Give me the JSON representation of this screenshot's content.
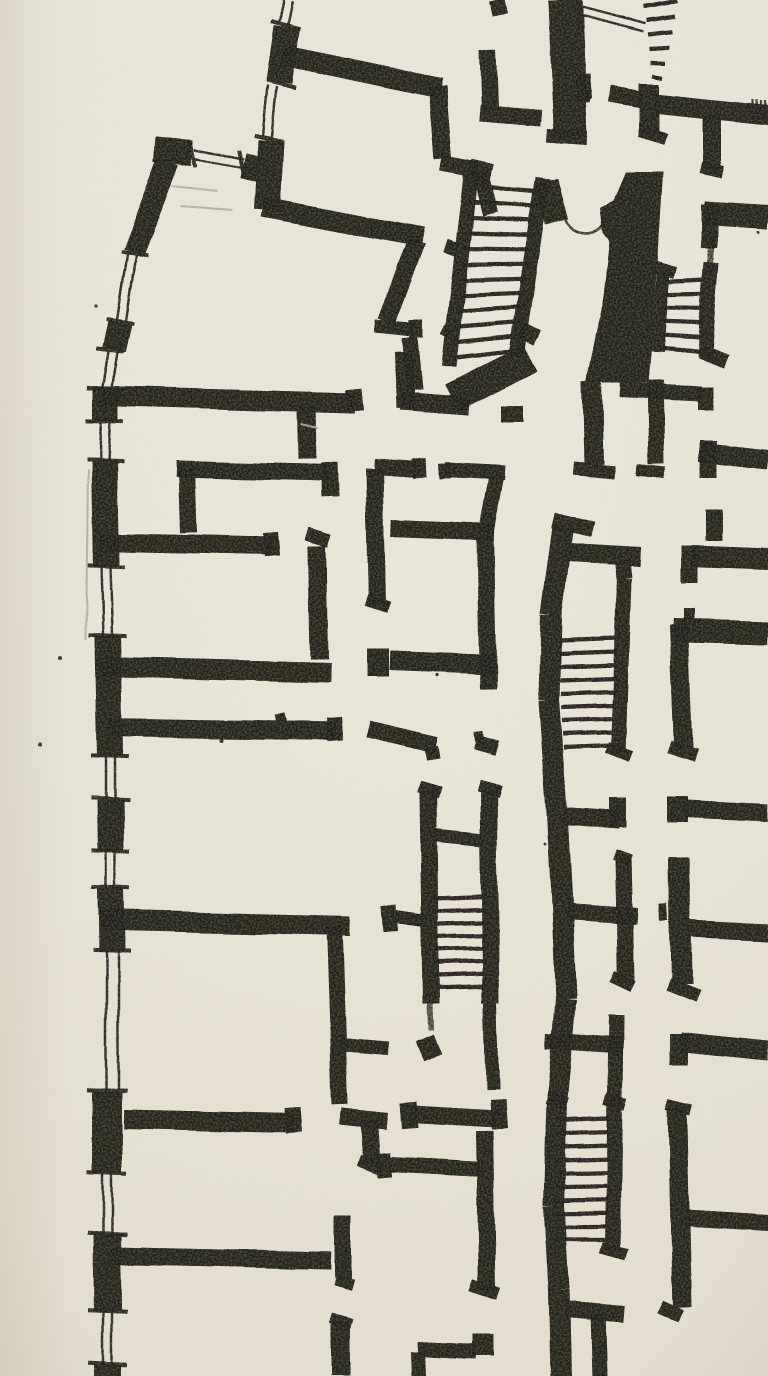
{
  "meta": {
    "title": "Hand-drawn architectural floor plan sketch (pencil on paper)",
    "canvas": {
      "width": 768,
      "height": 1376
    }
  },
  "palette": {
    "paper": "#ebe7da",
    "paper_low": "#e6e1d2",
    "ink": "#1c1b15",
    "pencil": "#b4ad9c",
    "edge_shadow": "#8a8066"
  },
  "plan": {
    "walls": [
      [
        106,
        386,
        106,
        421,
        26
      ],
      [
        104,
        461,
        106,
        566,
        26
      ],
      [
        108,
        636,
        110,
        756,
        26
      ],
      [
        110,
        799,
        111,
        851,
        26
      ],
      [
        111,
        888,
        112,
        951,
        26
      ],
      [
        107,
        1091,
        107,
        1173,
        30
      ],
      [
        107,
        1234,
        108,
        1311,
        28
      ],
      [
        108,
        1365,
        108,
        1376,
        28
      ],
      [
        287,
        27,
        279,
        82,
        26
      ],
      [
        271,
        140,
        267,
        210,
        26
      ],
      [
        155,
        150,
        192,
        153,
        26
      ],
      [
        243,
        165,
        259,
        169,
        26
      ],
      [
        168,
        162,
        133,
        253,
        22
      ],
      [
        120,
        322,
        114,
        350,
        24
      ],
      [
        283,
        55,
        440,
        88,
        21
      ],
      [
        437,
        86,
        443,
        160,
        18
      ],
      [
        441,
        164,
        478,
        171,
        16
      ],
      [
        481,
        173,
        491,
        214,
        16
      ],
      [
        263,
        207,
        422,
        237,
        20
      ],
      [
        416,
        241,
        386,
        321,
        18
      ],
      [
        374,
        326,
        414,
        330,
        14
      ],
      [
        416,
        320,
        416,
        338,
        14
      ],
      [
        409,
        338,
        414,
        390,
        16
      ],
      [
        400,
        401,
        470,
        406,
        18
      ],
      [
        403,
        352,
        405,
        408,
        18
      ],
      [
        487,
        50,
        489,
        109,
        17
      ],
      [
        479,
        113,
        541,
        118,
        17
      ],
      [
        565,
        0,
        571,
        137,
        34
      ],
      [
        547,
        136,
        588,
        139,
        14
      ],
      [
        577,
        95,
        591,
        97,
        12
      ],
      [
        497,
        0,
        500,
        14,
        15
      ],
      [
        471,
        176,
        449,
        366,
        15
      ],
      [
        543,
        178,
        516,
        356,
        15
      ],
      [
        546,
        181,
        557,
        222,
        24
      ],
      [
        470,
        170,
        492,
        175,
        20
      ],
      [
        452,
        398,
        530,
        358,
        30
      ],
      [
        513,
        406,
        513,
        422,
        22
      ],
      [
        445,
        246,
        457,
        250,
        14
      ],
      [
        443,
        330,
        451,
        334,
        10
      ],
      [
        521,
        330,
        537,
        338,
        16
      ],
      [
        649,
        84,
        649,
        134,
        20
      ],
      [
        640,
        132,
        666,
        140,
        12
      ],
      [
        654,
        103,
        768,
        115,
        20
      ],
      [
        610,
        94,
        643,
        100,
        16
      ],
      [
        583,
        75,
        585,
        100,
        14
      ],
      [
        712,
        114,
        712,
        170,
        18
      ],
      [
        701,
        168,
        723,
        173,
        12
      ],
      [
        704,
        213,
        768,
        217,
        24
      ],
      [
        709,
        204,
        709,
        248,
        16
      ],
      [
        711,
        230,
        711,
        272,
        6,
        0.65
      ],
      [
        664,
        273,
        657,
        352,
        13
      ],
      [
        712,
        262,
        704,
        358,
        15
      ],
      [
        655,
        267,
        676,
        273,
        12
      ],
      [
        700,
        352,
        726,
        362,
        14
      ],
      [
        592,
        382,
        594,
        464,
        20
      ],
      [
        573,
        468,
        615,
        472,
        13
      ],
      [
        655,
        380,
        657,
        464,
        16
      ],
      [
        637,
        470,
        666,
        473,
        12
      ],
      [
        620,
        390,
        701,
        394,
        16
      ],
      [
        705,
        387,
        705,
        411,
        16
      ],
      [
        700,
        452,
        768,
        460,
        20
      ],
      [
        709,
        441,
        709,
        478,
        17
      ],
      [
        713,
        509,
        713,
        541,
        17
      ],
      [
        691,
        556,
        768,
        559,
        21
      ],
      [
        690,
        546,
        690,
        583,
        17
      ],
      [
        673,
        630,
        768,
        633,
        24
      ],
      [
        679,
        624,
        684,
        748,
        19
      ],
      [
        670,
        746,
        697,
        755,
        13
      ],
      [
        689,
        608,
        689,
        622,
        11
      ],
      [
        678,
        797,
        678,
        822,
        20
      ],
      [
        686,
        809,
        768,
        813,
        17
      ],
      [
        680,
        858,
        682,
        984,
        21
      ],
      [
        668,
        984,
        698,
        996,
        13
      ],
      [
        690,
        929,
        768,
        933,
        17
      ],
      [
        664,
        903,
        665,
        921,
        8
      ],
      [
        679,
        1034,
        679,
        1064,
        19
      ],
      [
        681,
        1042,
        768,
        1051,
        19
      ],
      [
        677,
        1107,
        682,
        1307,
        19
      ],
      [
        667,
        1104,
        691,
        1110,
        11
      ],
      [
        684,
        1218,
        768,
        1223,
        17
      ],
      [
        660,
        1306,
        680,
        1316,
        14
      ],
      [
        563,
        527,
        551,
        615,
        21
      ],
      [
        551,
        615,
        549,
        700,
        21
      ],
      [
        549,
        700,
        557,
        812,
        21
      ],
      [
        557,
        812,
        562,
        905,
        21
      ],
      [
        562,
        905,
        566,
        1000,
        21
      ],
      [
        566,
        1000,
        557,
        1100,
        21
      ],
      [
        557,
        1100,
        554,
        1205,
        21
      ],
      [
        554,
        1205,
        559,
        1290,
        21
      ],
      [
        559,
        1290,
        561,
        1376,
        21
      ],
      [
        553,
        520,
        592,
        529,
        16
      ],
      [
        568,
        553,
        641,
        557,
        19
      ],
      [
        622,
        561,
        624,
        578,
        16
      ],
      [
        624,
        578,
        618,
        753,
        15
      ],
      [
        607,
        748,
        631,
        757,
        12
      ],
      [
        563,
        816,
        619,
        820,
        17
      ],
      [
        617,
        799,
        617,
        827,
        17
      ],
      [
        566,
        911,
        638,
        916,
        17
      ],
      [
        623,
        858,
        626,
        982,
        17
      ],
      [
        614,
        854,
        631,
        860,
        11
      ],
      [
        612,
        976,
        633,
        986,
        12
      ],
      [
        616,
        1016,
        613,
        1250,
        15
      ],
      [
        605,
        1099,
        626,
        1105,
        12
      ],
      [
        602,
        1248,
        627,
        1255,
        12
      ],
      [
        547,
        1099,
        567,
        1105,
        12
      ],
      [
        546,
        1041,
        623,
        1046,
        16
      ],
      [
        566,
        1310,
        624,
        1315,
        17
      ],
      [
        598,
        1315,
        600,
        1376,
        15
      ],
      [
        428,
        793,
        431,
        1004,
        17
      ],
      [
        488,
        791,
        491,
        1002,
        17
      ],
      [
        419,
        788,
        440,
        794,
        12
      ],
      [
        478,
        786,
        500,
        792,
        12
      ],
      [
        434,
        835,
        483,
        840,
        13
      ],
      [
        396,
        917,
        424,
        921,
        13
      ],
      [
        389,
        906,
        391,
        932,
        15
      ],
      [
        491,
        1002,
        493,
        1090,
        13
      ],
      [
        424,
        1038,
        432,
        1058,
        20
      ],
      [
        410,
        1114,
        498,
        1119,
        17
      ],
      [
        407,
        1102,
        409,
        1128,
        16
      ],
      [
        498,
        1100,
        500,
        1129,
        16
      ],
      [
        485,
        1131,
        488,
        1289,
        17
      ],
      [
        472,
        1284,
        499,
        1293,
        13
      ],
      [
        389,
        1164,
        484,
        1169,
        15
      ],
      [
        383,
        1153,
        385,
        1177,
        14
      ],
      [
        417,
        1349,
        477,
        1352,
        15
      ],
      [
        484,
        1334,
        484,
        1356,
        22
      ],
      [
        417,
        1352,
        418,
        1376,
        15
      ],
      [
        100,
        396,
        355,
        403,
        20
      ],
      [
        354,
        389,
        356,
        411,
        16
      ],
      [
        306,
        406,
        307,
        458,
        19
      ],
      [
        176,
        468,
        329,
        472,
        17
      ],
      [
        330,
        462,
        331,
        497,
        17
      ],
      [
        186,
        468,
        188,
        533,
        16
      ],
      [
        100,
        542,
        271,
        546,
        18
      ],
      [
        270,
        533,
        272,
        556,
        15
      ],
      [
        317,
        546,
        319,
        659,
        18
      ],
      [
        307,
        534,
        330,
        541,
        13
      ],
      [
        100,
        667,
        330,
        673,
        20
      ],
      [
        378,
        648,
        378,
        676,
        22
      ],
      [
        390,
        660,
        494,
        664,
        20
      ],
      [
        374,
        466,
        417,
        469,
        15
      ],
      [
        417,
        459,
        418,
        477,
        14
      ],
      [
        374,
        468,
        377,
        604,
        17
      ],
      [
        366,
        600,
        389,
        607,
        12
      ],
      [
        444,
        470,
        506,
        473,
        15
      ],
      [
        443,
        464,
        444,
        479,
        12
      ],
      [
        497,
        477,
        487,
        533,
        15
      ],
      [
        391,
        529,
        495,
        533,
        17
      ],
      [
        486,
        536,
        489,
        688,
        17
      ],
      [
        109,
        727,
        336,
        731,
        19
      ],
      [
        334,
        717,
        336,
        741,
        15
      ],
      [
        279,
        713,
        281,
        722,
        10
      ],
      [
        368,
        728,
        436,
        744,
        17
      ],
      [
        431,
        746,
        433,
        759,
        14
      ],
      [
        476,
        742,
        497,
        748,
        15
      ],
      [
        479,
        731,
        480,
        741,
        9
      ],
      [
        100,
        920,
        350,
        926,
        20
      ],
      [
        334,
        926,
        340,
        1104,
        16
      ],
      [
        339,
        1045,
        388,
        1049,
        13
      ],
      [
        341,
        1116,
        387,
        1121,
        17
      ],
      [
        369,
        1121,
        372,
        1164,
        17
      ],
      [
        359,
        1161,
        383,
        1170,
        12
      ],
      [
        124,
        1119,
        294,
        1123,
        19
      ],
      [
        292,
        1108,
        294,
        1133,
        16
      ],
      [
        113,
        1256,
        330,
        1261,
        18
      ],
      [
        342,
        1216,
        342,
        1279,
        17
      ],
      [
        334,
        1280,
        352,
        1285,
        11
      ],
      [
        341,
        1323,
        341,
        1376,
        19
      ],
      [
        331,
        1319,
        352,
        1325,
        11
      ],
      [
        430,
        1004,
        431,
        1030,
        6,
        0.6
      ]
    ],
    "windows": [
      [
        289,
        0,
        284,
        24,
        9
      ],
      [
        272,
        86,
        267,
        136,
        9
      ],
      [
        194,
        154,
        243,
        163,
        9
      ],
      [
        131,
        255,
        121,
        320,
        9
      ],
      [
        113,
        352,
        107,
        387,
        9
      ],
      [
        106,
        421,
        104,
        461,
        9
      ],
      [
        106,
        566,
        108,
        636,
        9
      ],
      [
        110,
        756,
        110,
        798,
        9
      ],
      [
        111,
        851,
        111,
        888,
        9
      ],
      [
        112,
        951,
        112,
        1090,
        12
      ],
      [
        107,
        1173,
        107,
        1234,
        9
      ],
      [
        108,
        1311,
        108,
        1365,
        9
      ],
      [
        579,
        10,
        643,
        27,
        8
      ]
    ],
    "sills": [
      [
        286,
        25,
        30,
        15
      ],
      [
        281,
        84,
        30,
        14
      ],
      [
        269,
        138,
        30,
        12
      ],
      [
        193,
        154,
        26,
        80
      ],
      [
        241,
        162,
        26,
        80
      ],
      [
        134,
        254,
        28,
        10
      ],
      [
        120,
        321,
        28,
        8
      ],
      [
        110,
        350,
        28,
        6
      ],
      [
        106,
        388,
        38,
        2
      ],
      [
        105,
        421,
        38,
        2
      ],
      [
        105,
        461,
        38,
        2
      ],
      [
        106,
        566,
        38,
        2
      ],
      [
        108,
        636,
        38,
        2
      ],
      [
        110,
        756,
        38,
        2
      ],
      [
        110,
        798,
        38,
        2
      ],
      [
        111,
        851,
        38,
        2
      ],
      [
        111,
        888,
        38,
        2
      ],
      [
        112,
        950,
        38,
        2
      ],
      [
        107,
        1090,
        40,
        2
      ],
      [
        107,
        1173,
        40,
        2
      ],
      [
        107,
        1234,
        40,
        2
      ],
      [
        108,
        1311,
        40,
        2
      ],
      [
        108,
        1364,
        40,
        2
      ]
    ],
    "stairs": [
      {
        "l": [
          471,
          186,
          452,
          358
        ],
        "r": [
          541,
          192,
          520,
          350
        ],
        "n": 12
      },
      {
        "l": [
          643,
          6,
          653,
          76
        ],
        "r": [
          678,
          0,
          663,
          78
        ],
        "n": 6
      },
      {
        "l": [
          663,
          282,
          658,
          348
        ],
        "r": [
          708,
          280,
          701,
          352
        ],
        "n": 6
      },
      {
        "l": [
          558,
          640,
          564,
          748
        ],
        "r": [
          618,
          638,
          612,
          746
        ],
        "n": 9
      },
      {
        "l": [
          556,
          1120,
          554,
          1240
        ],
        "r": [
          610,
          1118,
          607,
          1240
        ],
        "n": 10
      },
      {
        "l": [
          434,
          898,
          436,
          988
        ],
        "r": [
          485,
          896,
          487,
          986
        ],
        "n": 8
      }
    ],
    "door_arcs": [
      "M562,209 Q567,232 586,233",
      "M609,212 Q603,233 586,233"
    ],
    "poche": [
      [
        [
          625,
          172
        ],
        [
          663,
          172
        ],
        [
          656,
          290
        ],
        [
          648,
          383
        ],
        [
          586,
          383
        ],
        [
          603,
          295
        ],
        [
          609,
          240
        ],
        [
          603,
          232
        ],
        [
          600,
          207
        ],
        [
          613,
          200
        ]
      ]
    ],
    "hatch": [
      [
        753,
        99,
        753,
        118
      ],
      [
        757,
        99,
        757,
        119
      ],
      [
        761,
        100,
        761,
        120
      ],
      [
        765,
        100,
        765,
        120
      ]
    ],
    "pencil": [
      [
        172,
        186,
        216,
        191
      ],
      [
        180,
        206,
        232,
        210
      ],
      [
        88,
        470,
        86,
        640
      ],
      [
        300,
        424,
        318,
        428
      ]
    ],
    "specks": [
      [
        60,
        658,
        2
      ],
      [
        40,
        744,
        2
      ],
      [
        222,
        740,
        2
      ],
      [
        96,
        306,
        1.6
      ],
      [
        436,
        675,
        1.6
      ],
      [
        758,
        232,
        1.5
      ],
      [
        545,
        843,
        1.4
      ],
      [
        764,
        566,
        1.4
      ],
      [
        658,
        228,
        1.8
      ]
    ]
  }
}
